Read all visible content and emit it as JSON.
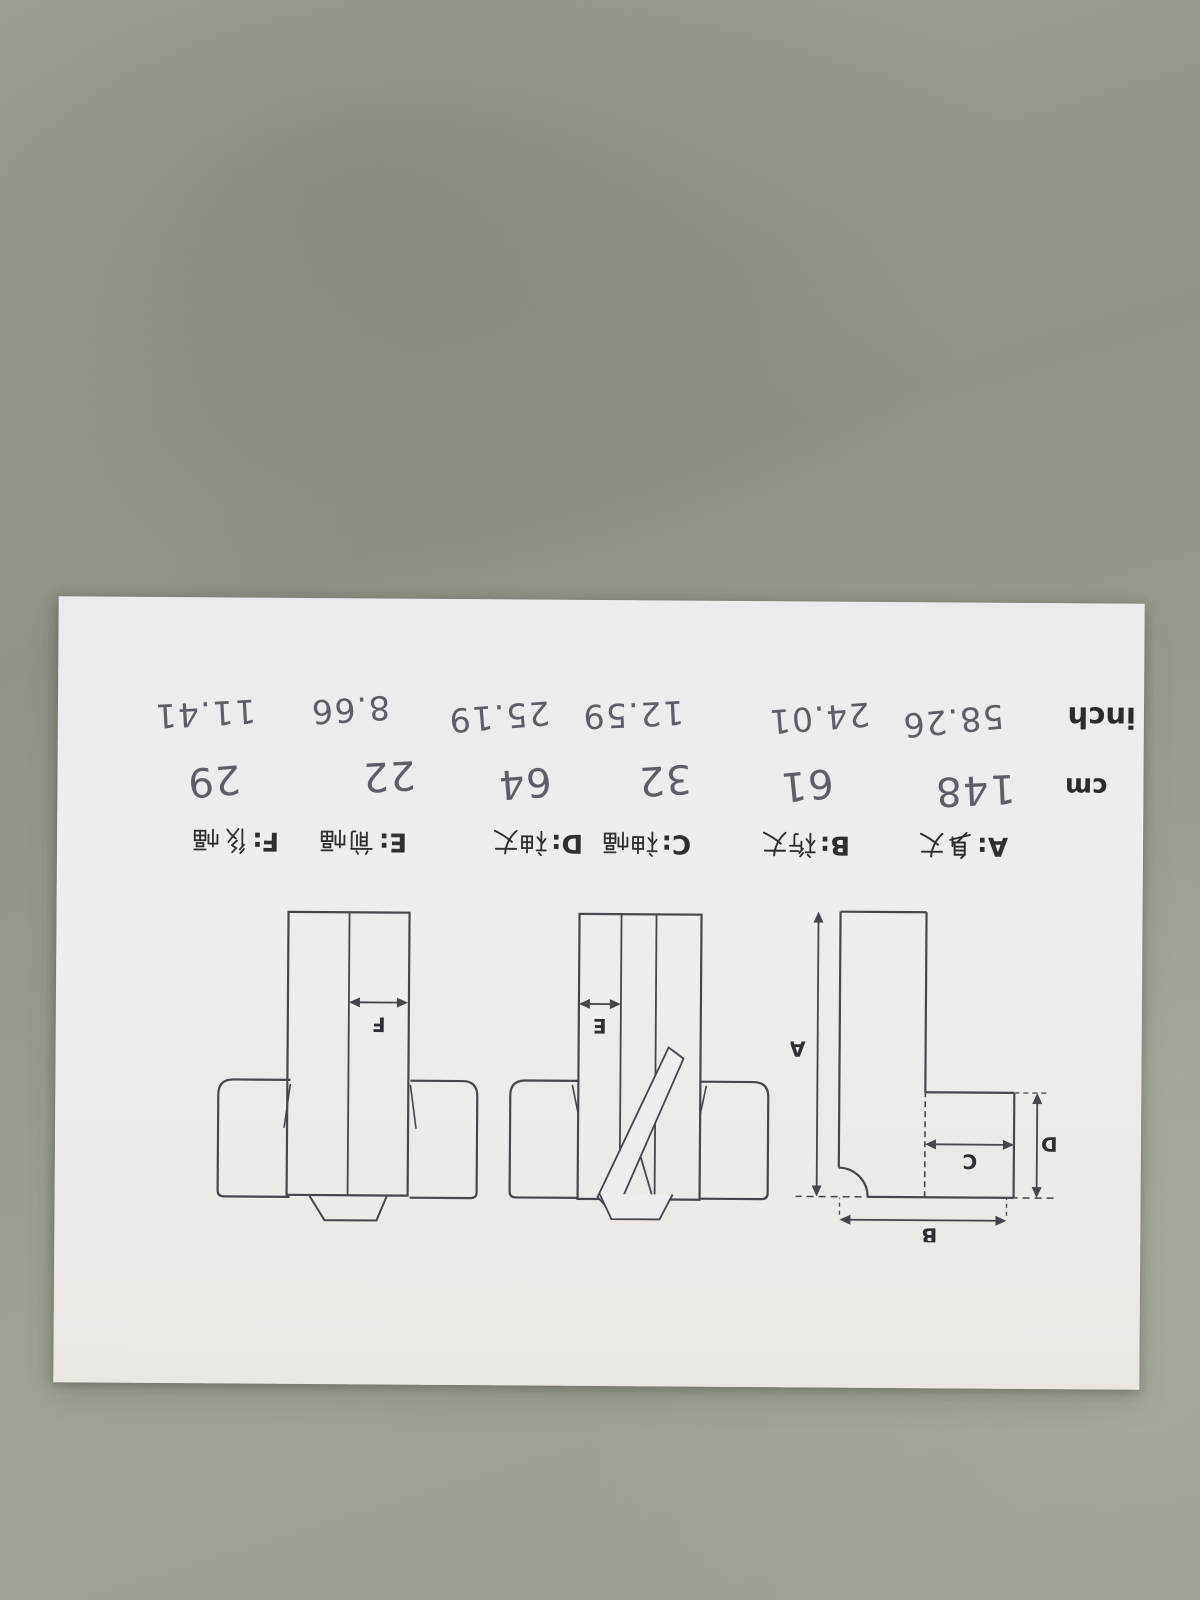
{
  "paper": {
    "orientation": "rotated-180-degrees",
    "legend": {
      "items": [
        {
          "code": "A:",
          "label": "身丈"
        },
        {
          "code": "B:",
          "label": "裄丈"
        },
        {
          "code": "C:",
          "label": "袖幅"
        },
        {
          "code": "D:",
          "label": "袖丈"
        },
        {
          "code": "E:",
          "label": "前幅"
        },
        {
          "code": "F:",
          "label": "後幅"
        }
      ]
    },
    "measurements": {
      "cm": {
        "label": "cm",
        "values": [
          "148",
          "61",
          "32",
          "64",
          "22",
          "29"
        ]
      },
      "inch": {
        "label": "inch",
        "values": [
          "58.26",
          "24.01",
          "12.59",
          "25.19",
          "8.66",
          "11.41"
        ]
      }
    },
    "diagram_labels": {
      "A": "A",
      "B": "B",
      "C": "C",
      "D": "D",
      "E": "E",
      "F": "F"
    }
  },
  "colors": {
    "background": "#979a8d",
    "paper": "#ebebee",
    "print_ink": "#2e2e33",
    "pen_ink": "#5f5e68",
    "diagram_line": "#46464c"
  }
}
